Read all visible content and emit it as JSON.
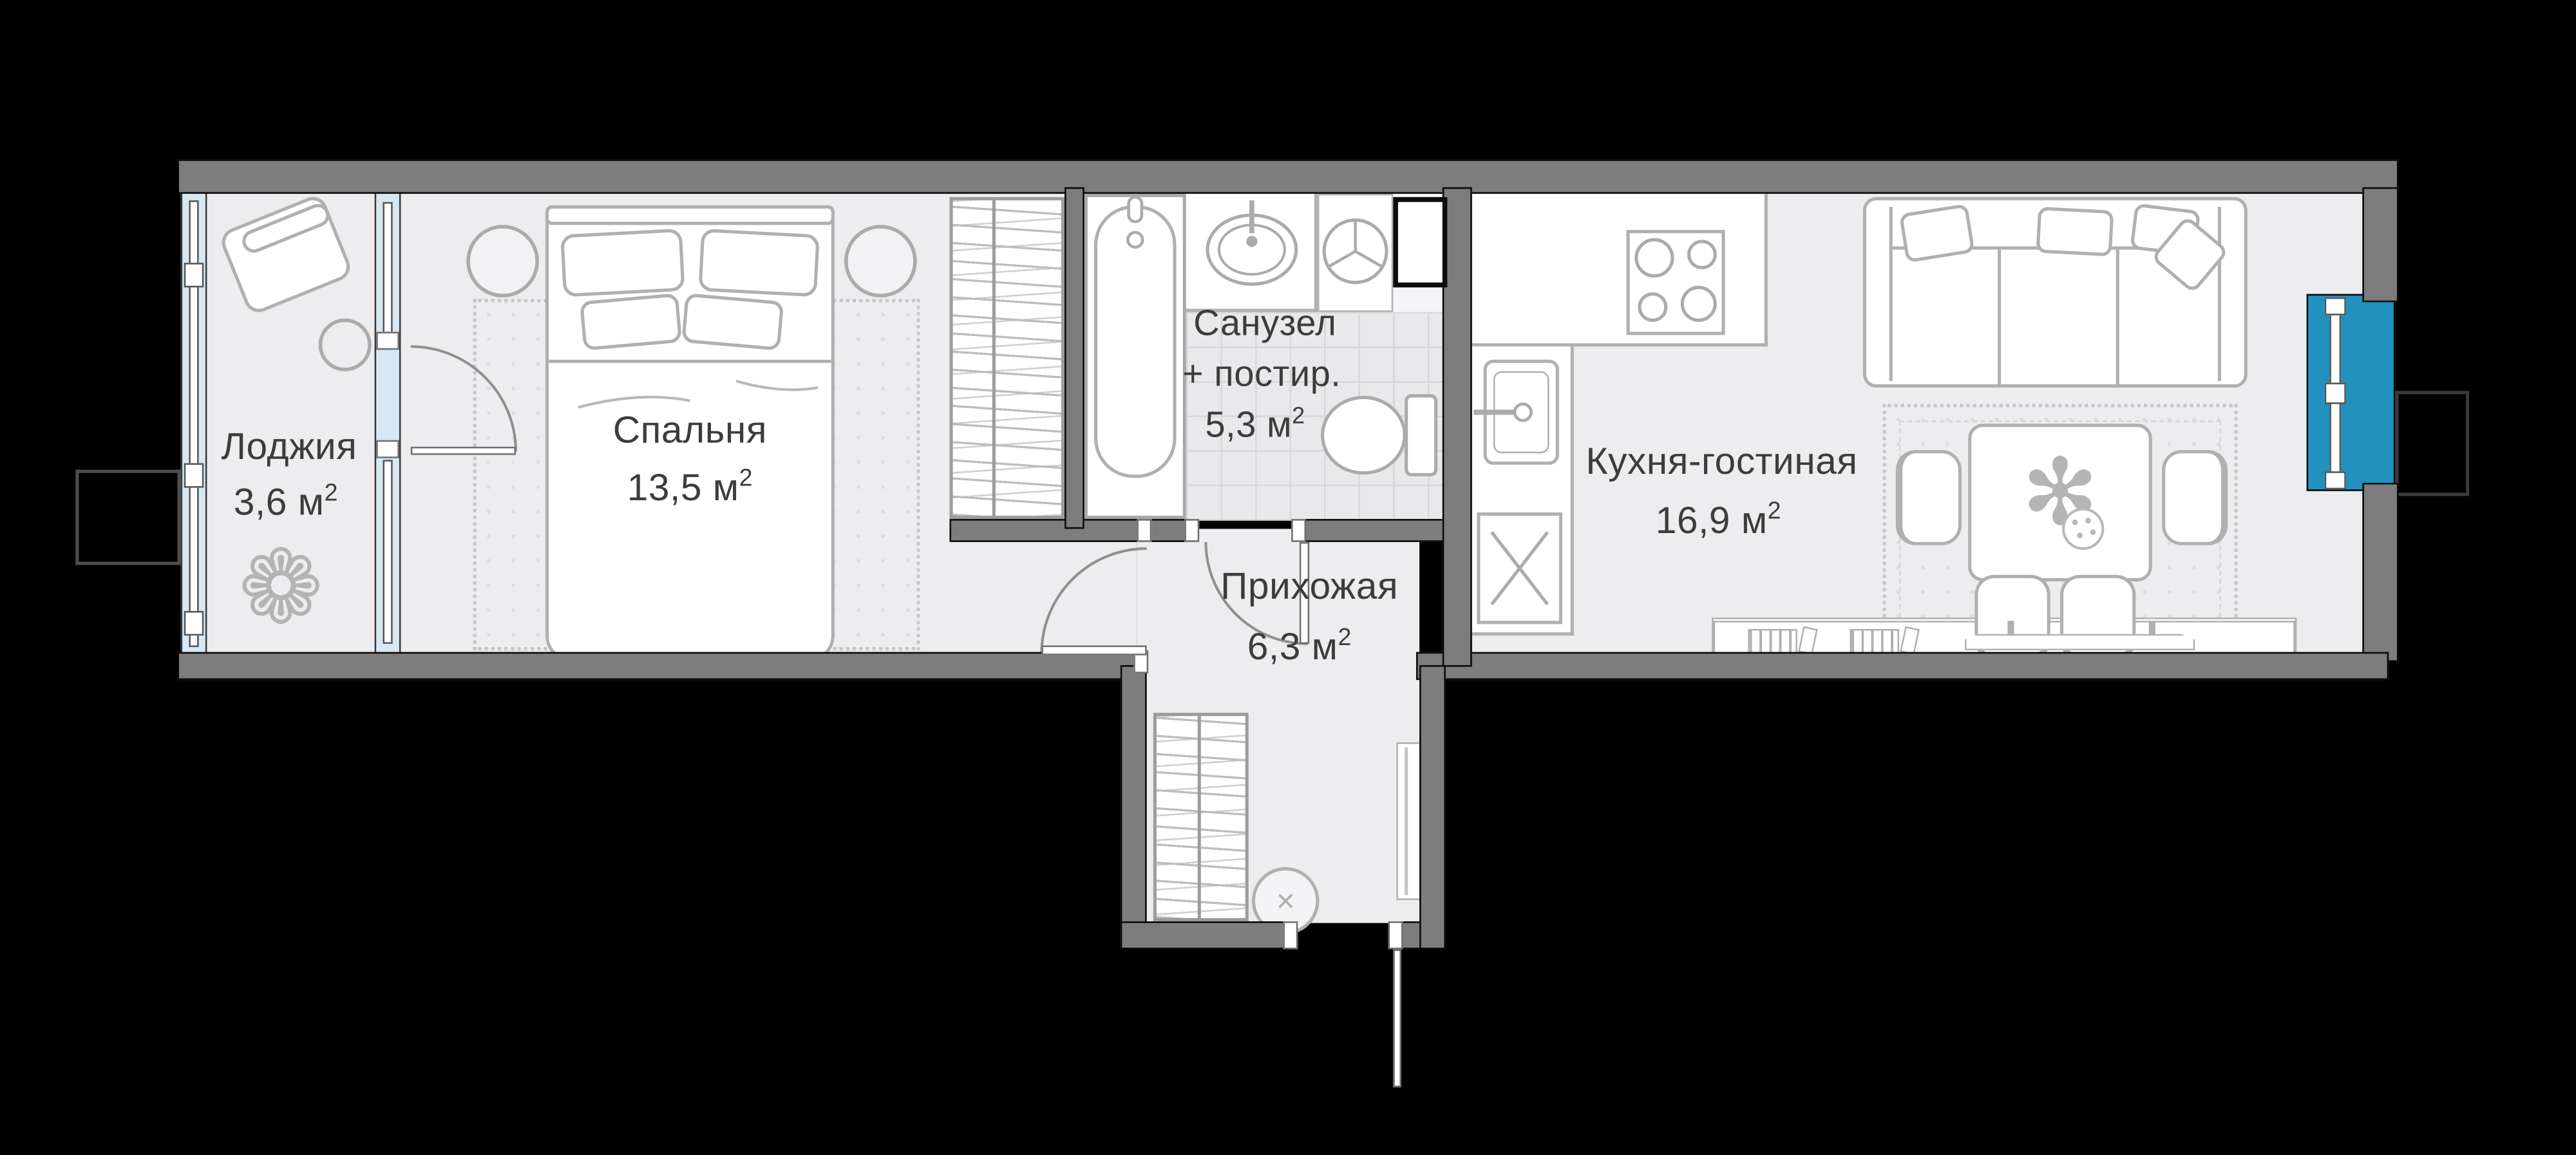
{
  "floorplan": {
    "type": "apartment-floor-plan",
    "rooms": [
      {
        "id": "loggia",
        "name": "Лоджия",
        "area": "3,6 м²"
      },
      {
        "id": "bedroom",
        "name": "Спальня",
        "area": "13,5 м²"
      },
      {
        "id": "bathroom",
        "name": "Санузел",
        "subtitle": "+ постир.",
        "area": "5,3 м²"
      },
      {
        "id": "hallway",
        "name": "Прихожая",
        "area": "6,3 м²"
      },
      {
        "id": "kitchen_living",
        "name": "Кухня-гостиная",
        "area": "16,9 м²"
      }
    ],
    "icons": {
      "loggia_plant": "❁",
      "table_plant": "✻",
      "pouf_cross": "✕"
    },
    "colors": {
      "background": "#000000",
      "wall": "#7D7D7D",
      "floor": "#EDEDEF",
      "glazing_light": "#D6E8F4",
      "accent_window_teal": "#2191BE",
      "furniture_stroke": "#B0B0B0",
      "tile_line": "#D8D8DB",
      "label_text": "#3C3C3C"
    }
  }
}
